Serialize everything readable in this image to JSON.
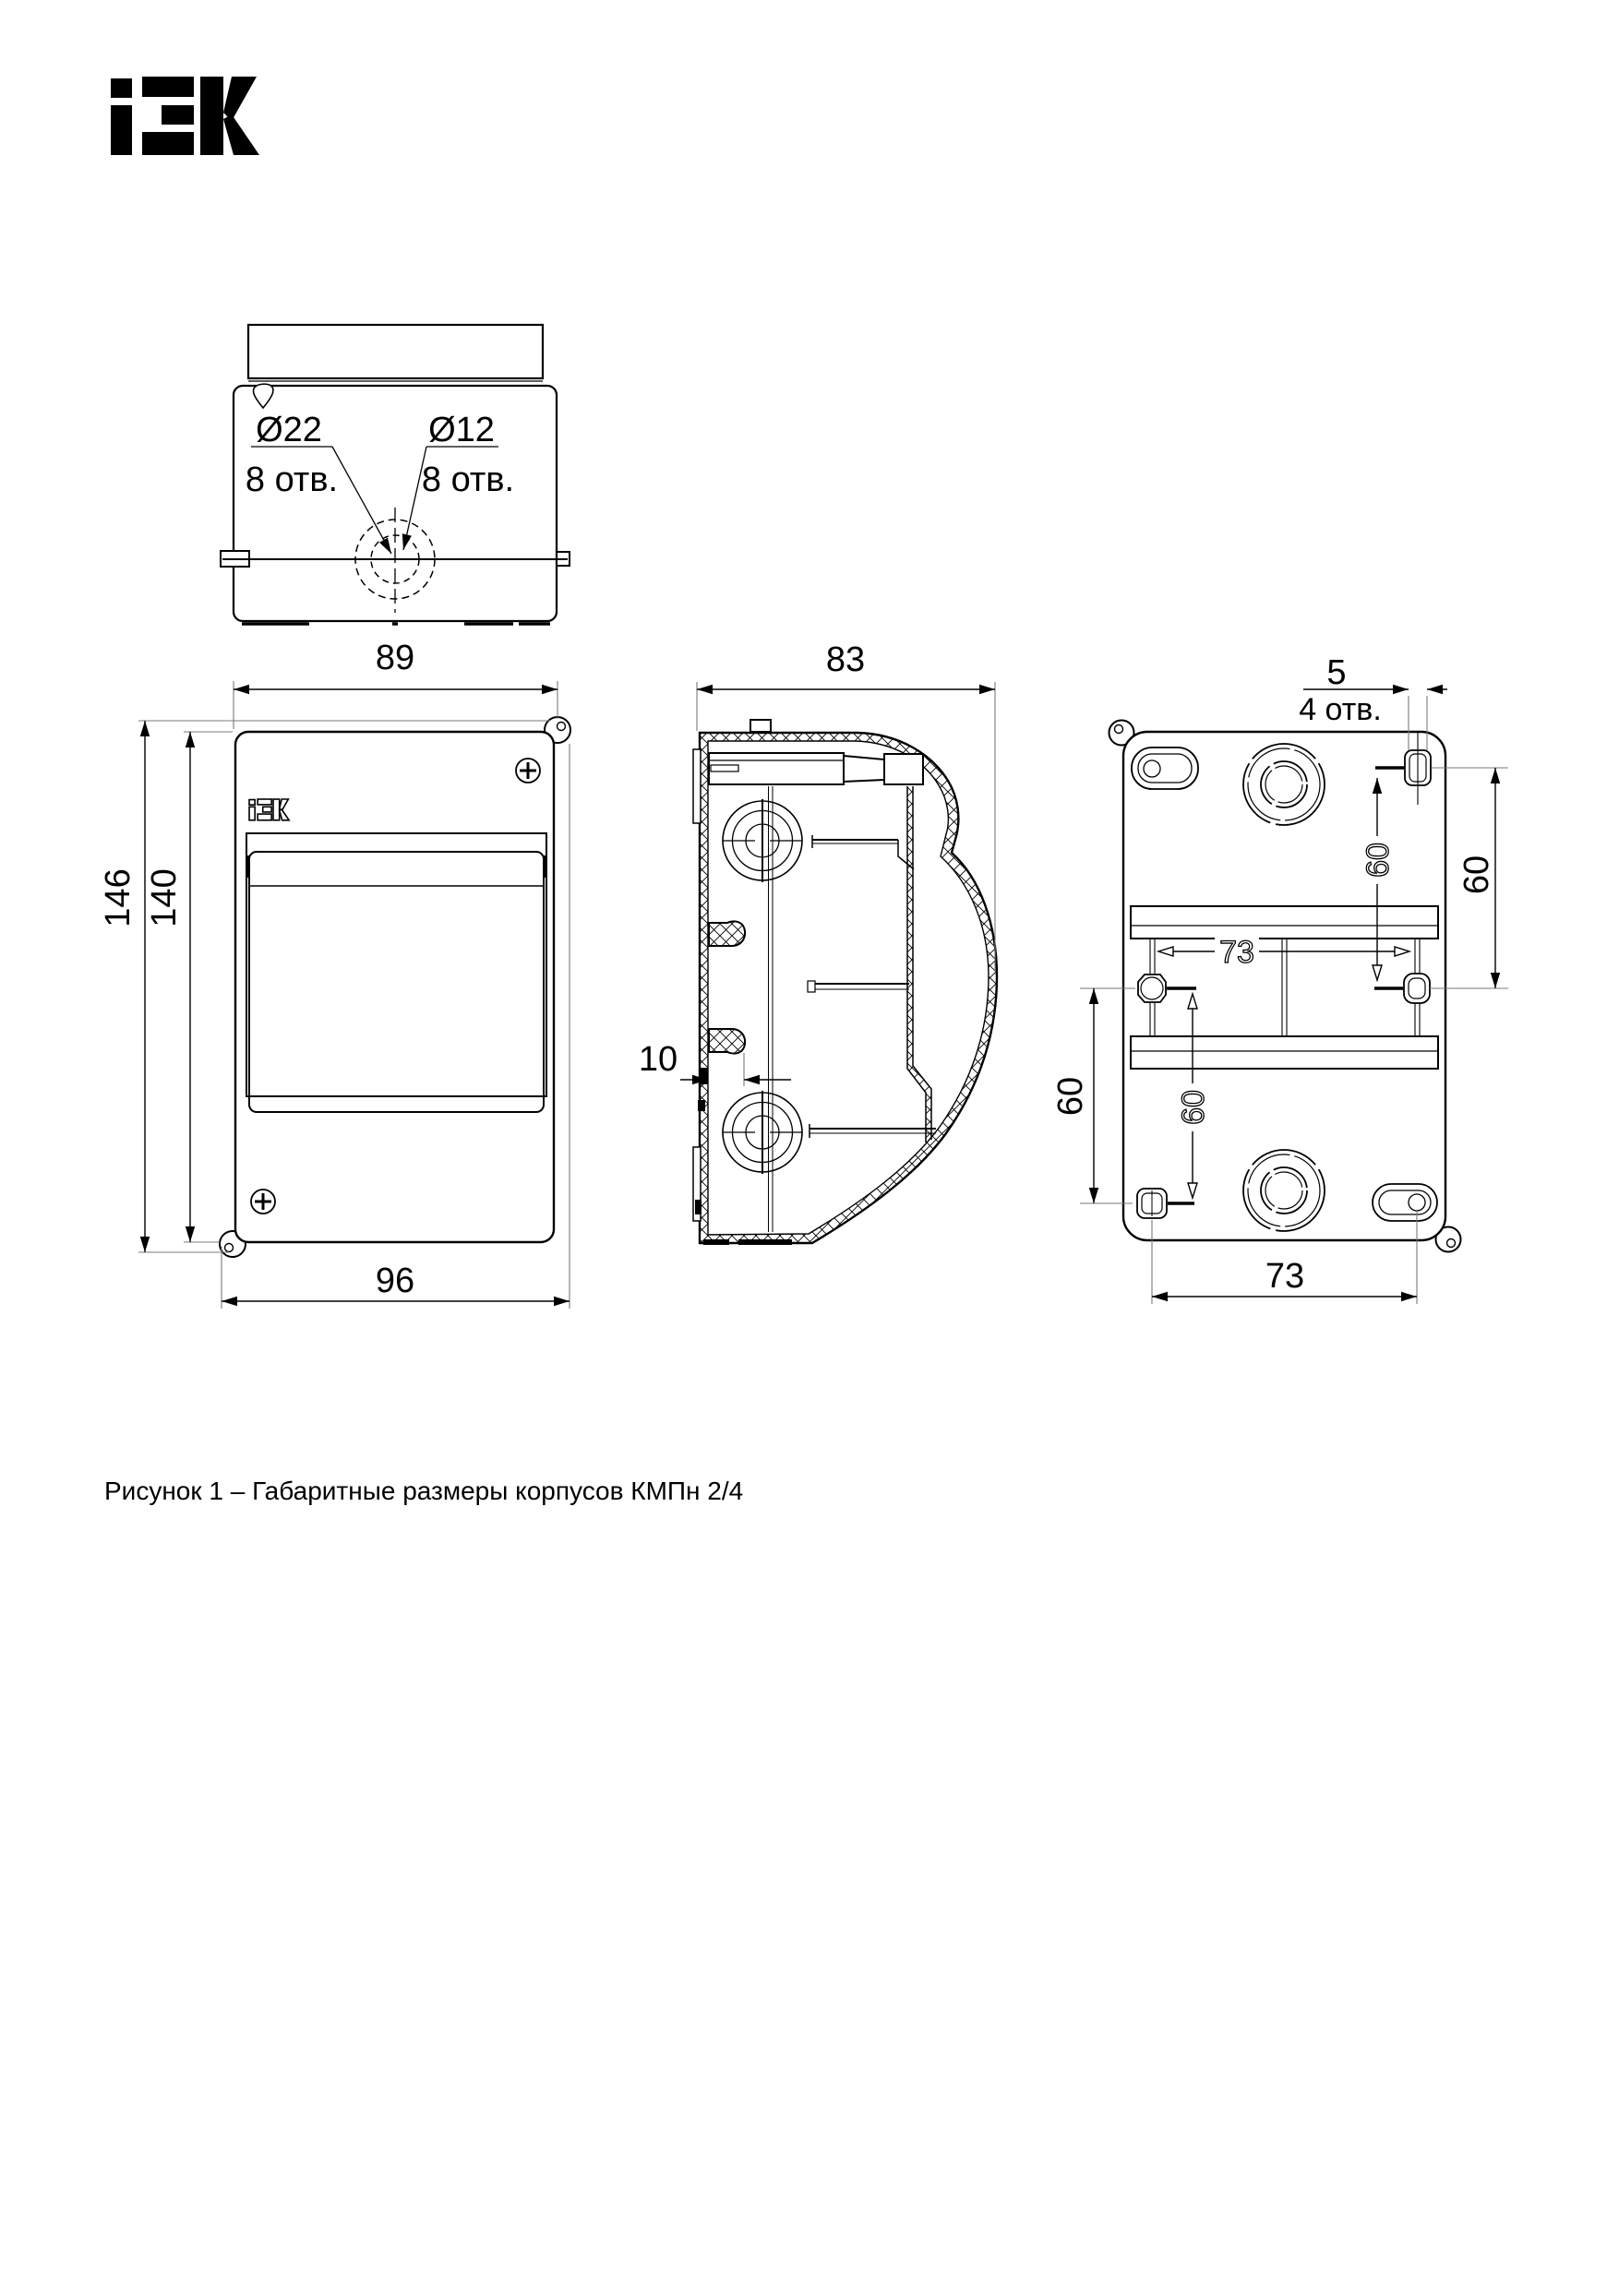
{
  "page": {
    "caption": "Рисунок 1 – Габаритные размеры корпусов КМПн 2/4",
    "background": "#ffffff",
    "line_color": "#000000",
    "ext_line_color": "#7a7a7a"
  },
  "logo": {
    "brand": "iEK"
  },
  "top_view": {
    "knockout_large_dia": "Ø22",
    "knockout_large_count": "8 отв.",
    "knockout_small_dia": "Ø12",
    "knockout_small_count": "8 отв."
  },
  "front_view": {
    "dim_width_top": "89",
    "dim_height_overall": "146",
    "dim_height_body": "140",
    "dim_width_bottom": "96"
  },
  "side_view": {
    "dim_depth": "83",
    "dim_rail_offset": "10"
  },
  "rear_view": {
    "dim_slot_width": "5",
    "dim_slot_note": "4 отв.",
    "dim_right_span": "60",
    "dim_right_span_inner": "60",
    "dim_inner_width": "73",
    "dim_left_span_inner": "60",
    "dim_left_span": "60",
    "dim_bottom_width": "73"
  }
}
